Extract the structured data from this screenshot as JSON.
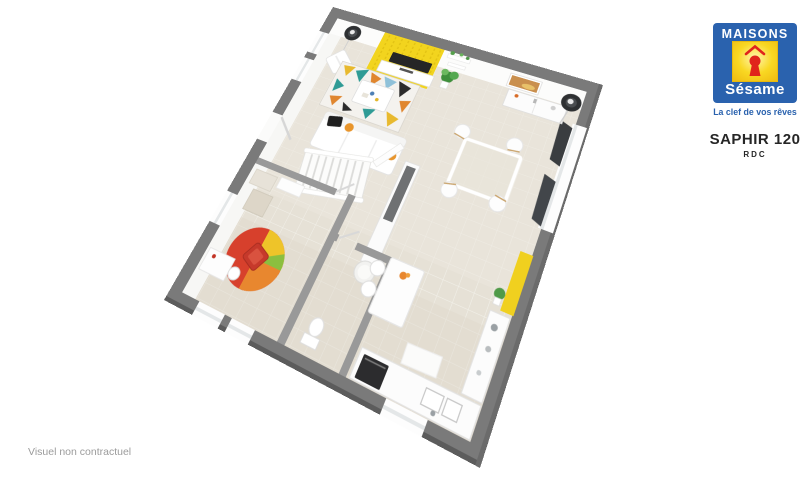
{
  "branding": {
    "brand_top": "MAISONS",
    "brand_bottom": "Sésame",
    "tagline": "La clef de vos rêves"
  },
  "plan_header": {
    "model": "SAPHIR 120",
    "level": "RDC"
  },
  "footer": {
    "disclaimer": "Visuel non contractuel"
  },
  "colors": {
    "brand_blue": "#2a62ae",
    "brand_gold": "#f6c713",
    "brand_red": "#e0251b",
    "wall_gray": "#7a7a7a",
    "floor_beige": "#e6e1d6",
    "accent_yellow": "#f2d41e"
  }
}
